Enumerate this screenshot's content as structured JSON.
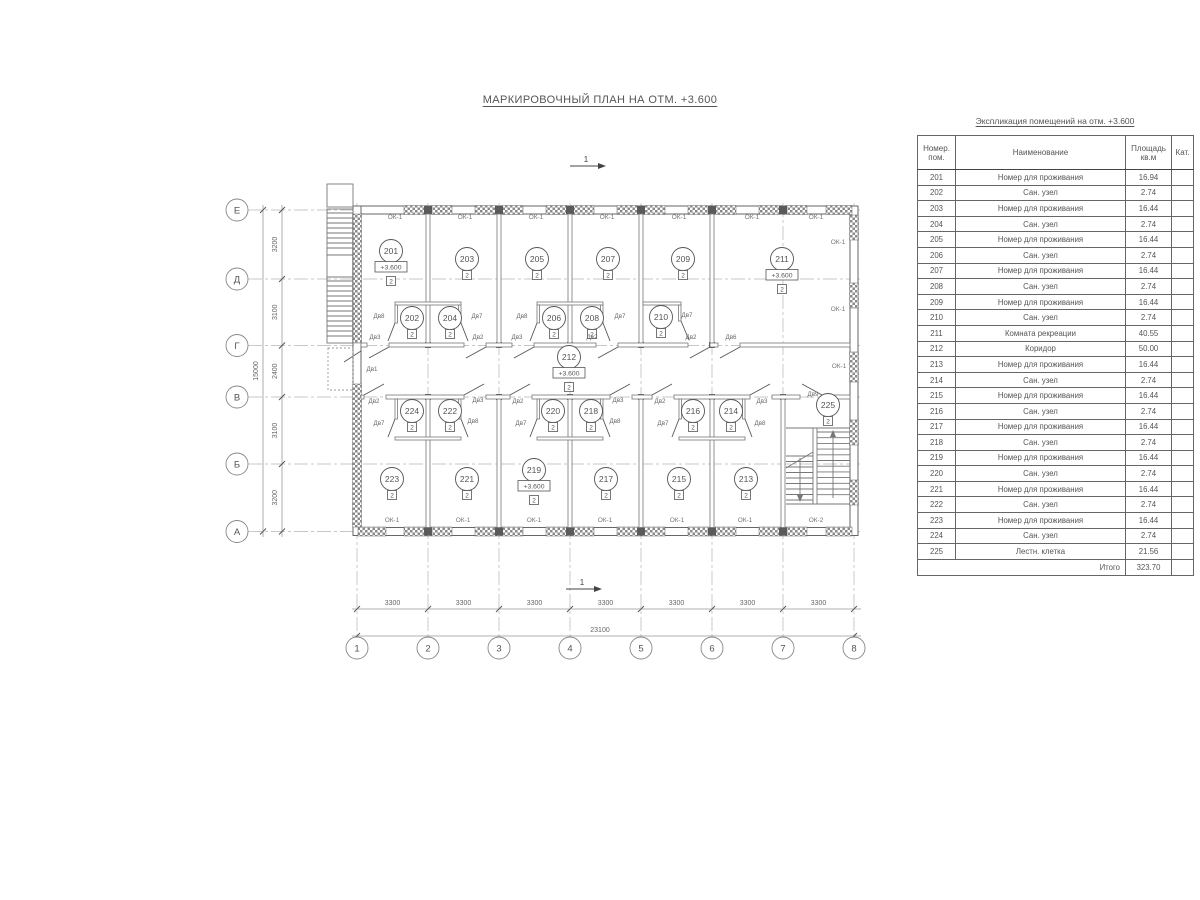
{
  "page_title": "МАРКИРОВОЧНЫЙ ПЛАН НА ОТМ. +3.600",
  "plan": {
    "section_mark": "1",
    "elevation_label": "+3.600",
    "category_label": "2",
    "row_axes": [
      "Е",
      "Д",
      "Г",
      "В",
      "Б",
      "А"
    ],
    "col_axes": [
      "1",
      "2",
      "3",
      "4",
      "5",
      "6",
      "7",
      "8"
    ],
    "left_dims": [
      "3200",
      "3100",
      "2400",
      "3100",
      "3200"
    ],
    "left_total": "15000",
    "bottom_dim": "3300",
    "bottom_total": "23100",
    "rooms": [
      {
        "number": "201",
        "x": 391,
        "y": 251,
        "elev": true
      },
      {
        "number": "203",
        "x": 467,
        "y": 259
      },
      {
        "number": "205",
        "x": 537,
        "y": 259
      },
      {
        "number": "207",
        "x": 608,
        "y": 259
      },
      {
        "number": "209",
        "x": 683,
        "y": 259
      },
      {
        "number": "211",
        "x": 782,
        "y": 259,
        "elev": true
      },
      {
        "number": "202",
        "x": 412,
        "y": 318
      },
      {
        "number": "204",
        "x": 450,
        "y": 318
      },
      {
        "number": "206",
        "x": 554,
        "y": 318
      },
      {
        "number": "208",
        "x": 592,
        "y": 318
      },
      {
        "number": "210",
        "x": 661,
        "y": 317
      },
      {
        "number": "212",
        "x": 569,
        "y": 357,
        "elev": true
      },
      {
        "number": "224",
        "x": 412,
        "y": 411
      },
      {
        "number": "222",
        "x": 450,
        "y": 411
      },
      {
        "number": "220",
        "x": 553,
        "y": 411
      },
      {
        "number": "218",
        "x": 591,
        "y": 411
      },
      {
        "number": "216",
        "x": 693,
        "y": 411
      },
      {
        "number": "214",
        "x": 731,
        "y": 411
      },
      {
        "number": "225",
        "x": 828,
        "y": 405
      },
      {
        "number": "223",
        "x": 392,
        "y": 479
      },
      {
        "number": "221",
        "x": 467,
        "y": 479
      },
      {
        "number": "219",
        "x": 534,
        "y": 470,
        "elev": true
      },
      {
        "number": "217",
        "x": 606,
        "y": 479
      },
      {
        "number": "215",
        "x": 679,
        "y": 479
      },
      {
        "number": "213",
        "x": 746,
        "y": 479
      }
    ],
    "window_labels": [
      {
        "label": "ОК-1",
        "x": 395,
        "y": 219
      },
      {
        "label": "ОК-1",
        "x": 465,
        "y": 219
      },
      {
        "label": "ОК-1",
        "x": 536,
        "y": 219
      },
      {
        "label": "ОК-1",
        "x": 607,
        "y": 219
      },
      {
        "label": "ОК-1",
        "x": 679,
        "y": 219
      },
      {
        "label": "ОК-1",
        "x": 752,
        "y": 219
      },
      {
        "label": "ОК-1",
        "x": 816,
        "y": 219
      },
      {
        "label": "ОК-1",
        "x": 838,
        "y": 244
      },
      {
        "label": "ОК-1",
        "x": 838,
        "y": 311
      },
      {
        "label": "ОК-1",
        "x": 839,
        "y": 368
      },
      {
        "label": "ОК-1",
        "x": 392,
        "y": 522
      },
      {
        "label": "ОК-1",
        "x": 463,
        "y": 522
      },
      {
        "label": "ОК-1",
        "x": 534,
        "y": 522
      },
      {
        "label": "ОК-1",
        "x": 605,
        "y": 522
      },
      {
        "label": "ОК-1",
        "x": 677,
        "y": 522
      },
      {
        "label": "ОК-1",
        "x": 745,
        "y": 522
      },
      {
        "label": "ОК-2",
        "x": 816,
        "y": 522
      }
    ],
    "door_labels": [
      {
        "label": "Дв1",
        "x": 372,
        "y": 371
      },
      {
        "label": "Дв8",
        "x": 379,
        "y": 318
      },
      {
        "label": "Дв7",
        "x": 477,
        "y": 318
      },
      {
        "label": "Дв8",
        "x": 522,
        "y": 318
      },
      {
        "label": "Дв7",
        "x": 620,
        "y": 318
      },
      {
        "label": "Дв7",
        "x": 687,
        "y": 317
      },
      {
        "label": "Дв3",
        "x": 375,
        "y": 339
      },
      {
        "label": "Дв2",
        "x": 478,
        "y": 339
      },
      {
        "label": "Дв3",
        "x": 517,
        "y": 339
      },
      {
        "label": "Дв2",
        "x": 592,
        "y": 339
      },
      {
        "label": "Дв2",
        "x": 691,
        "y": 339
      },
      {
        "label": "Дв6",
        "x": 731,
        "y": 339
      },
      {
        "label": "Дв2",
        "x": 374,
        "y": 403
      },
      {
        "label": "Дв3",
        "x": 478,
        "y": 402
      },
      {
        "label": "Дв2",
        "x": 518,
        "y": 403
      },
      {
        "label": "Дв3",
        "x": 618,
        "y": 402
      },
      {
        "label": "Дв2",
        "x": 660,
        "y": 403
      },
      {
        "label": "Дв3",
        "x": 762,
        "y": 403
      },
      {
        "label": "Дв9",
        "x": 813,
        "y": 396
      },
      {
        "label": "Дв7",
        "x": 379,
        "y": 425
      },
      {
        "label": "Дв8",
        "x": 473,
        "y": 423
      },
      {
        "label": "Дв7",
        "x": 521,
        "y": 425
      },
      {
        "label": "Дв8",
        "x": 615,
        "y": 423
      },
      {
        "label": "Дв7",
        "x": 663,
        "y": 425
      },
      {
        "label": "Дв8",
        "x": 760,
        "y": 425
      }
    ]
  },
  "table": {
    "title": "Экспликация помещений на отм. +3.600",
    "headers": [
      "Номер.\nпом.",
      "Наименование",
      "Площадь\nкв.м",
      "Кат."
    ],
    "rows": [
      {
        "num": "201",
        "name": "Номер для проживания",
        "area": "16.94",
        "cat": ""
      },
      {
        "num": "202",
        "name": "Сан. узел",
        "area": "2.74",
        "cat": ""
      },
      {
        "num": "203",
        "name": "Номер для проживания",
        "area": "16.44",
        "cat": ""
      },
      {
        "num": "204",
        "name": "Сан. узел",
        "area": "2.74",
        "cat": ""
      },
      {
        "num": "205",
        "name": "Номер для проживания",
        "area": "16.44",
        "cat": ""
      },
      {
        "num": "206",
        "name": "Сан. узел",
        "area": "2.74",
        "cat": ""
      },
      {
        "num": "207",
        "name": "Номер для проживания",
        "area": "16.44",
        "cat": ""
      },
      {
        "num": "208",
        "name": "Сан. узел",
        "area": "2.74",
        "cat": ""
      },
      {
        "num": "209",
        "name": "Номер для проживания",
        "area": "16.44",
        "cat": ""
      },
      {
        "num": "210",
        "name": "Сан. узел",
        "area": "2.74",
        "cat": ""
      },
      {
        "num": "211",
        "name": "Комната рекреации",
        "area": "40.55",
        "cat": ""
      },
      {
        "num": "212",
        "name": "Коридор",
        "area": "50.00",
        "cat": ""
      },
      {
        "num": "213",
        "name": "Номер для проживания",
        "area": "16.44",
        "cat": ""
      },
      {
        "num": "214",
        "name": "Сан. узел",
        "area": "2.74",
        "cat": ""
      },
      {
        "num": "215",
        "name": "Номер для проживания",
        "area": "16.44",
        "cat": ""
      },
      {
        "num": "216",
        "name": "Сан. узел",
        "area": "2.74",
        "cat": ""
      },
      {
        "num": "217",
        "name": "Номер для проживания",
        "area": "16.44",
        "cat": ""
      },
      {
        "num": "218",
        "name": "Сан. узел",
        "area": "2.74",
        "cat": ""
      },
      {
        "num": "219",
        "name": "Номер для проживания",
        "area": "16.44",
        "cat": ""
      },
      {
        "num": "220",
        "name": "Сан. узел",
        "area": "2.74",
        "cat": ""
      },
      {
        "num": "221",
        "name": "Номер для проживания",
        "area": "16.44",
        "cat": ""
      },
      {
        "num": "222",
        "name": "Сан. узел",
        "area": "2.74",
        "cat": ""
      },
      {
        "num": "223",
        "name": "Номер для проживания",
        "area": "16.44",
        "cat": ""
      },
      {
        "num": "224",
        "name": "Сан. узел",
        "area": "2.74",
        "cat": ""
      },
      {
        "num": "225",
        "name": "Лестн. клетка",
        "area": "21.56",
        "cat": ""
      }
    ],
    "total_label": "Итого",
    "total_value": "323.70"
  }
}
